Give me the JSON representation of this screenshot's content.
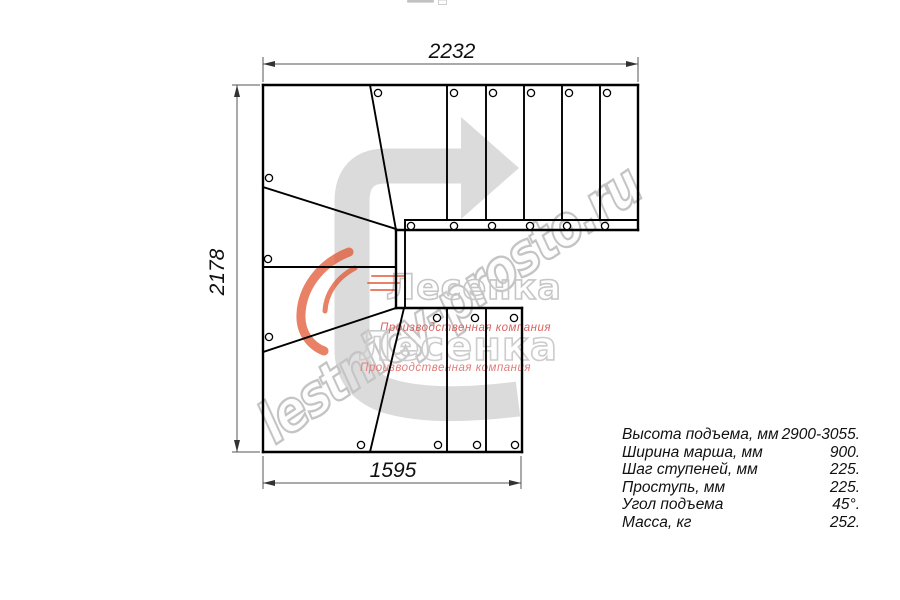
{
  "title": "Stair plan drawing (L-shaped staircase with winders, top view)",
  "drawing": {
    "dimensions": {
      "top": "2232",
      "left": "2178",
      "bottom": "1595"
    }
  },
  "specs": {
    "rows": [
      {
        "label": "Высота подъема, мм",
        "value": "2900-3055."
      },
      {
        "label": "Ширина марша, мм",
        "value": "900."
      },
      {
        "label": "Шаг ступеней, мм",
        "value": "225."
      },
      {
        "label": "Проступь, мм",
        "value": "225."
      },
      {
        "label": "Угол подъема",
        "value": "45°."
      },
      {
        "label": "Масса, кг",
        "value": "252."
      }
    ]
  },
  "watermark": {
    "url_text": "lestnicy-prosto.ru",
    "brand": "Лесенка",
    "tagline": "Производственная компания",
    "accent_color": "#e0512b",
    "outline_gray": "#c6c6c6",
    "arrow_gray": "#dbdbdb"
  },
  "colors": {
    "line": "#000000",
    "dimension": "#555555",
    "background": "#ffffff"
  }
}
